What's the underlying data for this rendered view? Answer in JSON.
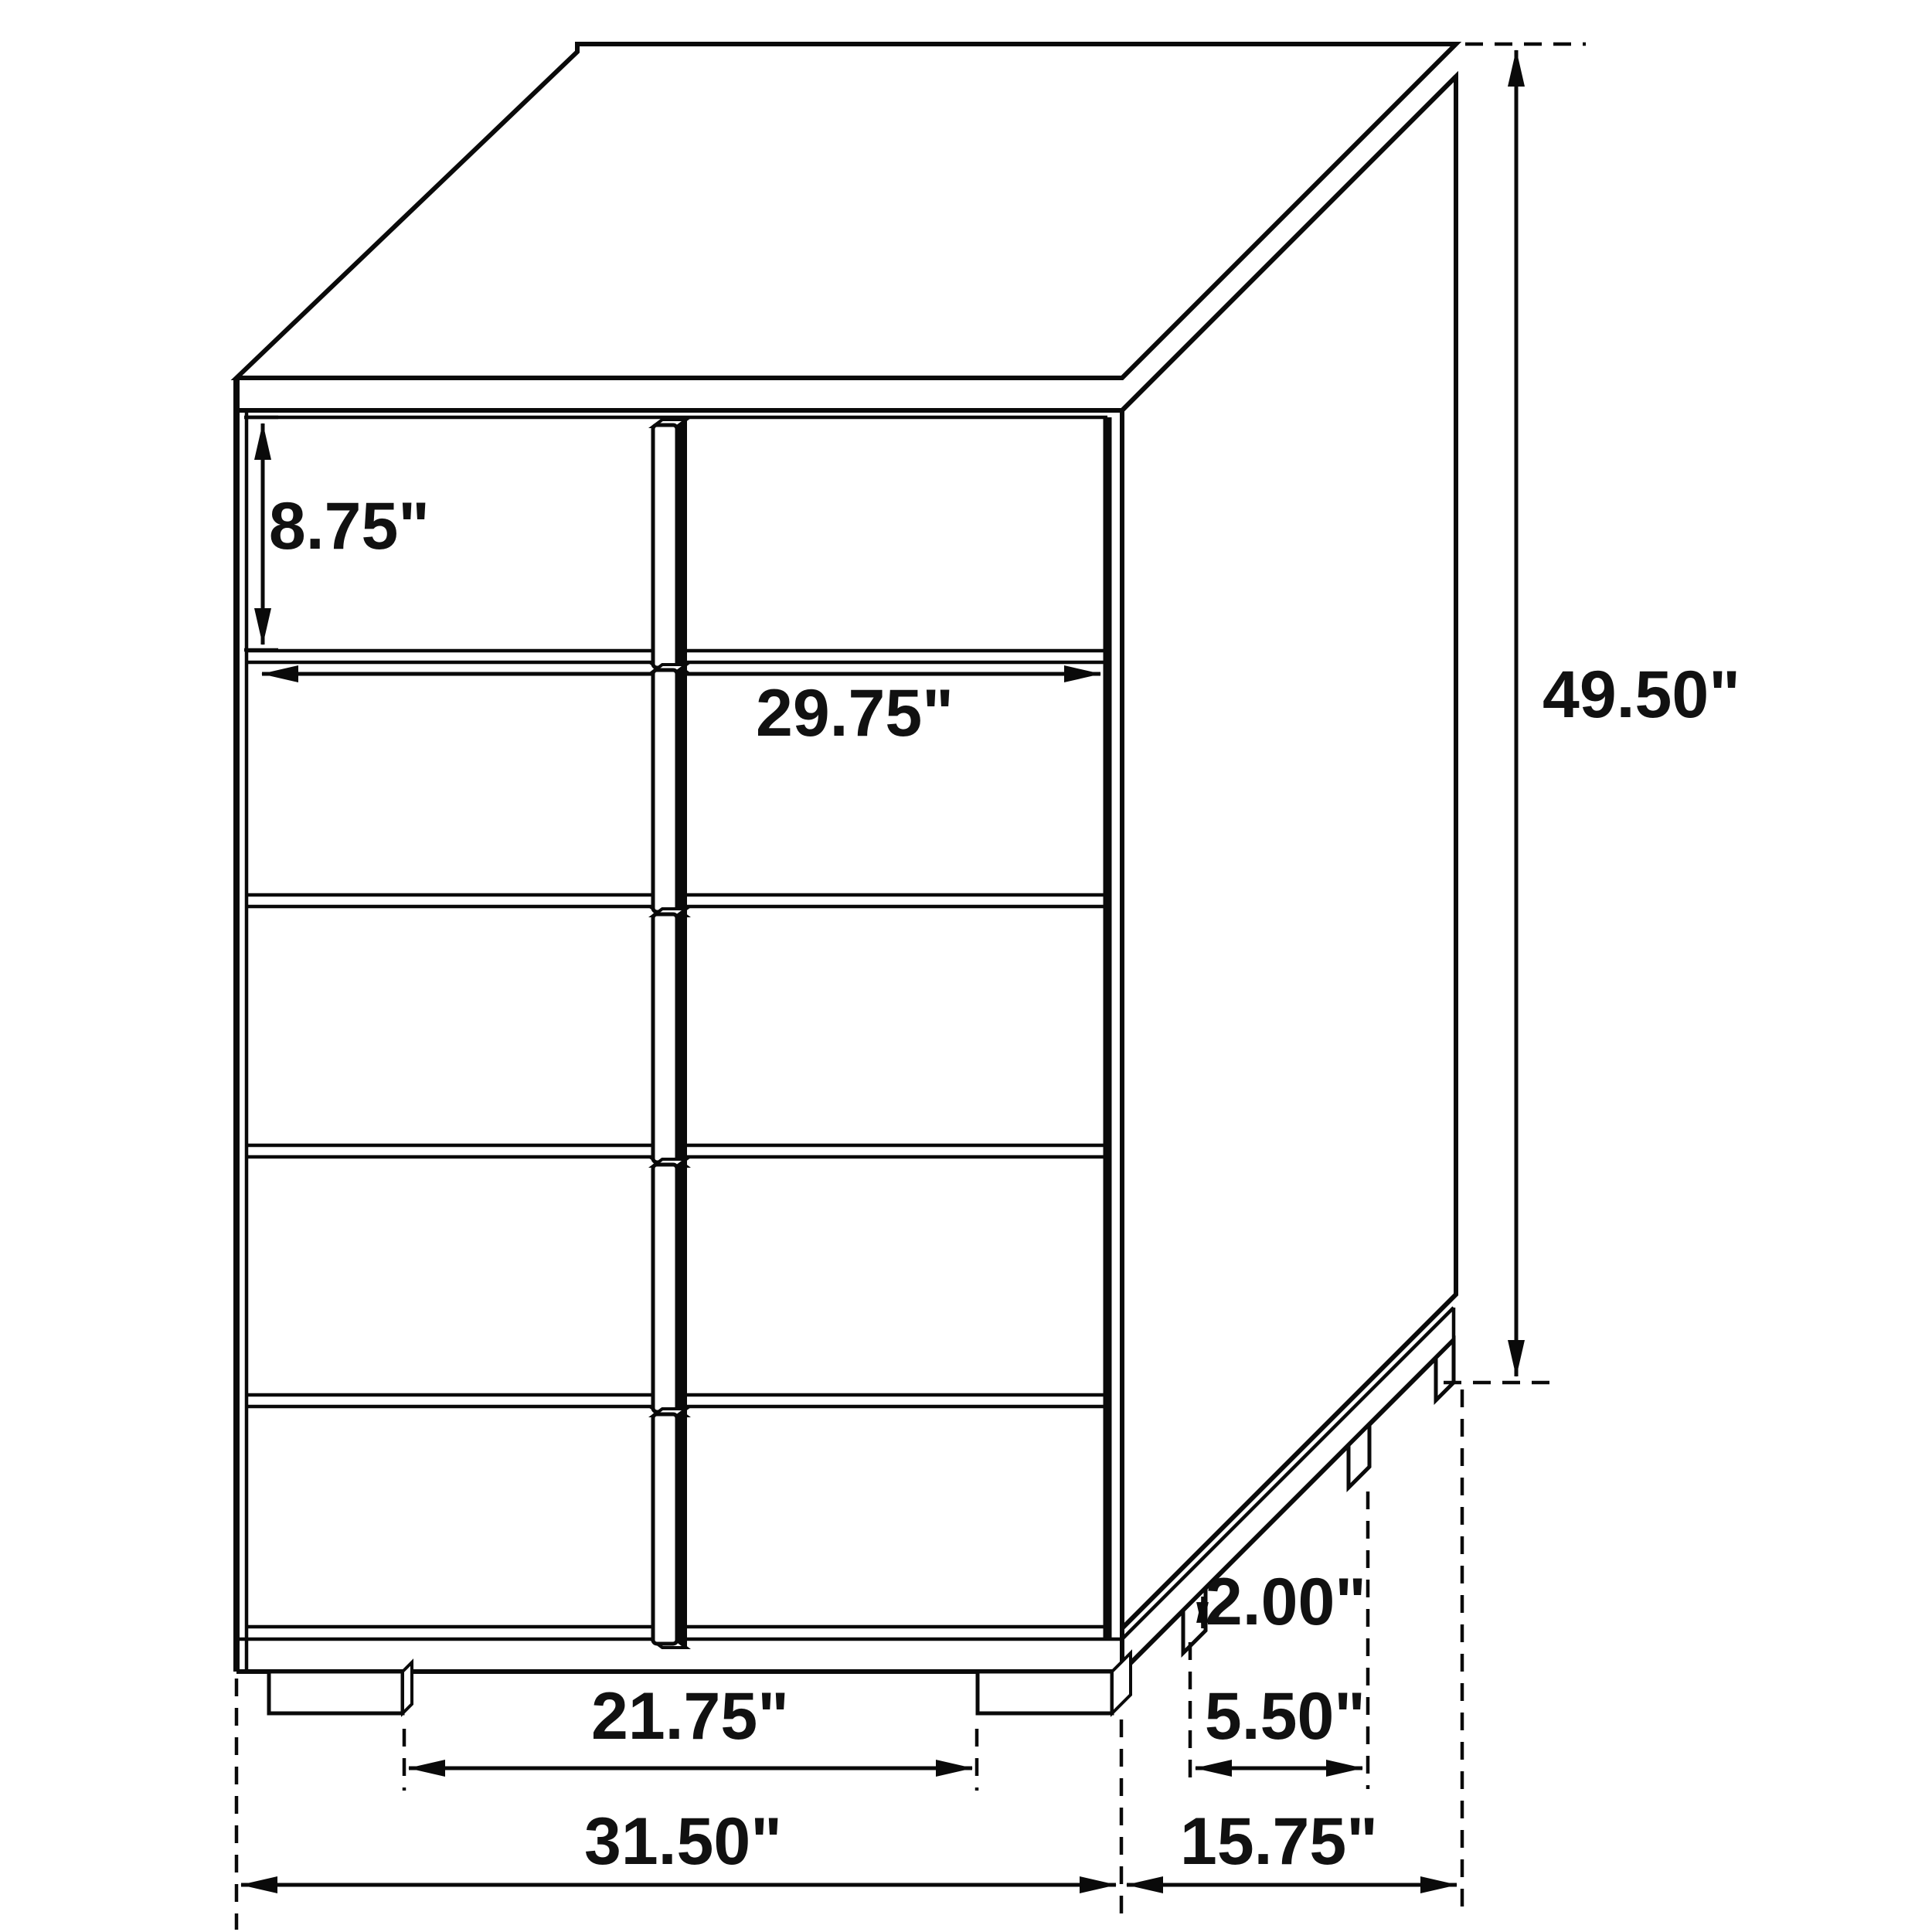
{
  "meta": {
    "background_color": "#ffffff",
    "line_color": "#0a0a0a",
    "text_color": "#111111"
  },
  "figure": {
    "kind": "furniture-dimension-diagram",
    "subject": "chest-of-drawers",
    "drawer_count": 5
  },
  "dimensions": {
    "drawer_height": "8.75\"",
    "drawer_width": "29.75\"",
    "overall_height": "49.50\"",
    "front_leg_spacing": "21.75\"",
    "overall_width": "31.50\"",
    "depth": "15.75\"",
    "side_leg_spacing": "5.50\"",
    "leg_height": "2.00\""
  }
}
